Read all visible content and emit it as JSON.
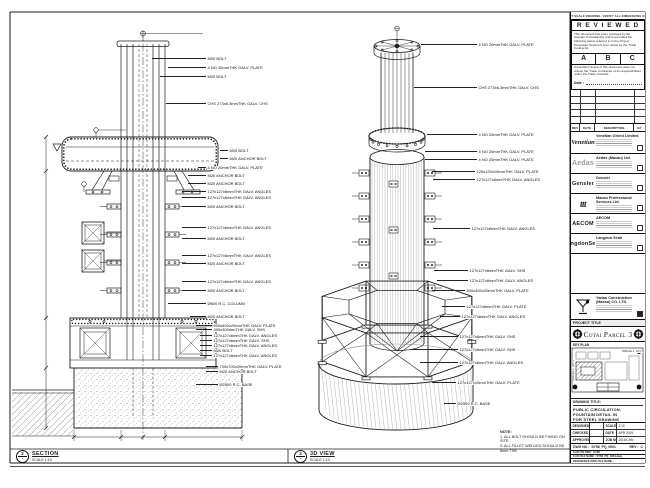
{
  "header_note": "DO NOT SCALE DRAWING. VERIFY ALL DIMENSIONS ON SITE",
  "reviewed": {
    "title": "R E V I E W E D",
    "para1": "This document has been reviewed by the relevant Consultant(s) and is accorded the following status referred to in the Project Procedure Section 5.4 for action by the Trade Contractor.",
    "options": [
      "A",
      "B",
      "C"
    ],
    "para2": "Consultant review of this document does not relieve the Trade Contractor of its responsibilities under the Trade Contract.",
    "date_label": "Date :"
  },
  "rev_table": {
    "headers": [
      "REV",
      "DATE",
      "DESCRIPTION",
      "BY"
    ]
  },
  "companies": [
    {
      "logo": "Venetian",
      "logo_style": "script",
      "name": "Venetian Orient Limited"
    },
    {
      "logo": "Aedas",
      "logo_style": "gray",
      "name": "Aedas (Macau) Ltd."
    },
    {
      "logo": "Gensler",
      "logo_style": "bold",
      "name": "Gensler"
    },
    {
      "logo": "ttt",
      "logo_style": "italic",
      "name": "Macau Professional Services Ltd."
    },
    {
      "logo": "AECOM",
      "logo_style": "bold",
      "name": "AECOM"
    },
    {
      "logo": "LangdonSeah",
      "logo_style": "bold",
      "name": "Langdon Seah"
    },
    {
      "logo": "",
      "logo_style": "none",
      "name": ""
    }
  ],
  "contractor": {
    "name": "Yadao Construction (Macau) CO. LTD."
  },
  "project": {
    "label": "PROJECT TITLE",
    "title": "Cotai Parcel 3"
  },
  "key_plan": {
    "title": "KEY PLAN",
    "labels": [
      "PARCEL 1, LOT 2",
      "PARCEL 1, LOT 1"
    ]
  },
  "drawing_title": {
    "label": "DRAWING TITLE:",
    "lines": [
      "PUBLIC CIRCULATION,",
      "FOUNTAIN DETAIL IN",
      "FOR STEEL DRAWING"
    ]
  },
  "info_table": {
    "rows": [
      {
        "k1": "DESIGNED",
        "v1": "",
        "k2": "SCALE",
        "v2": "1:10"
      },
      {
        "k1": "CHECKED",
        "v1": "-",
        "k2": "DATE",
        "v2": "APR 2015"
      },
      {
        "k1": "APPROVED",
        "v1": "-",
        "k2": "JOB NO.",
        "v2": "2015/CHN"
      }
    ]
  },
  "doc": {
    "dwg_label": "DWG NO :",
    "dwg_no": "SY58_PQ_0001",
    "rev_label": "REV :",
    "rev": "C",
    "row2": "CAD FOLDER : 9-508",
    "row3": "CAD FILE NAME : SY58_PQ_0001.dwg",
    "row4": "REFERENCE DWG FILE NAME :"
  },
  "views": {
    "left": {
      "bubble_top": "2",
      "bubble_bottom": "-",
      "title": "SECTION",
      "scale": "SCALE 1:10",
      "labels": [
        [
          "M20 BOLT",
          59,
          152,
          206
        ],
        [
          "4 NO 20mmTHK GALV. PLATE",
          68,
          168,
          206
        ],
        [
          "M20 BOLT",
          77,
          160,
          206
        ],
        [
          "CHS 273x6.3mmTHK GALV. CHS",
          104,
          166,
          206
        ],
        [
          "M20 BOLT",
          151,
          220,
          228
        ],
        [
          "M20 ANCHOR BOLT",
          159,
          220,
          228
        ],
        [
          "4 NO 20mmTHK GALV. PLATE",
          168,
          198,
          206
        ],
        [
          "M20 ANCHOR BOLT",
          176,
          188,
          206
        ],
        [
          "M20 ANCHOR BOLT",
          184,
          188,
          206
        ],
        [
          "127x127x6mmTHK GALV. ANGLES",
          192,
          182,
          206
        ],
        [
          "127x127x6mmTHK GALV. ANGLES",
          198,
          182,
          206
        ],
        [
          "M20 ANCHOR BOLT",
          207,
          182,
          206
        ],
        [
          "127x127x6mmTHK GALV. ANGLES",
          228,
          182,
          206
        ],
        [
          "M20 ANCHOR BOLT",
          239,
          182,
          206
        ],
        [
          "127x127x6mmTHK GALV. ANGLES",
          256,
          182,
          206
        ],
        [
          "M20 ANCHOR BOLT",
          264,
          182,
          206
        ],
        [
          "127x127x6mmTHK GALV. ANGLES",
          282,
          182,
          206
        ],
        [
          "M20 ANCHOR BOLT",
          291,
          182,
          206
        ],
        [
          "Ø600 R.C. COLUMN",
          304,
          168,
          206
        ],
        [
          "M20 ANCHOR BOLT",
          317,
          190,
          206
        ],
        [
          "600x600x20mmTHK GALV. PLATE",
          326,
          196,
          212
        ],
        [
          "300x300mmTHK GALV. SHS",
          330,
          196,
          212
        ],
        [
          "127x127x6mmTHK GALV. ANGLES",
          336,
          200,
          212
        ],
        [
          "127x127x6mmTHK GALV. SHS",
          341,
          200,
          212
        ],
        [
          "127x127x6mmTHK GALV. ANGLES",
          346,
          200,
          212
        ],
        [
          "M20 BOLT",
          351,
          200,
          212
        ],
        [
          "127x127x6mmTHK GALV. ANGLES",
          356,
          200,
          212
        ],
        [
          "700x700x20mmTHK GALV. PLATE",
          367,
          206,
          218
        ],
        [
          "M20 ANCHOR BOLT",
          372,
          206,
          218
        ],
        [
          "Ø2500 R.C. BASE",
          385,
          196,
          218
        ]
      ]
    },
    "right": {
      "bubble_top": "3",
      "bubble_bottom": "-",
      "title": "3D VIEW",
      "scale": "SCALE 1:10",
      "labels": [
        [
          "4 NO 20mmTHK GALV. PLATE",
          45,
          421,
          477
        ],
        [
          "CHS 273x6.3mmTHK GALV. CHS",
          88,
          414,
          477
        ],
        [
          "4 NO 20mmTHK GALV. PLATE",
          135,
          427,
          477
        ],
        [
          "4 NO 20mmTHK GALV. PLATE",
          152,
          425,
          477
        ],
        [
          "4 NO 20mmTHK GALV. PLATE",
          160,
          425,
          477
        ],
        [
          "120x120x10mmTHK GALV. PLATE",
          172,
          432,
          475
        ],
        [
          "127x127x6mmTHK GALV. ANGLES",
          180,
          433,
          475
        ],
        [
          "127x127x6mmTHK GALV. ANGLES",
          229,
          433,
          470
        ],
        [
          "127x127x6mmTHK GALV. SHS",
          271,
          434,
          468
        ],
        [
          "127x127x6mmTHK GALV. ANGLES",
          281,
          437,
          468
        ],
        [
          "400x400x20mmTHK GALV. PLATE",
          291,
          432,
          465
        ],
        [
          "127x127x6mmTHK GALV. PLATE",
          307,
          442,
          465
        ],
        [
          "127x127x6mmTHK GALV. ANGLES",
          317,
          440,
          460
        ],
        [
          "127x127x6mmTHK GALV. SHS",
          337,
          420,
          458
        ],
        [
          "127x127x6mmTHK GALV. SHS",
          350,
          410,
          458
        ],
        [
          "127x127x6mmTHK GALV. ANGLES",
          363,
          420,
          458
        ],
        [
          "127x127x10mmTHK GALV. PLATE",
          383,
          432,
          456
        ],
        [
          "Ø2500 R.C. BASE",
          404,
          444,
          456
        ]
      ]
    }
  },
  "notes": {
    "title": "NOTE:",
    "items": [
      "1. ALL BOLT SHOULD BE FIXING ON SITE.",
      "2. ALL FILLET WELDED SHOULD BE 6mm THK."
    ]
  }
}
